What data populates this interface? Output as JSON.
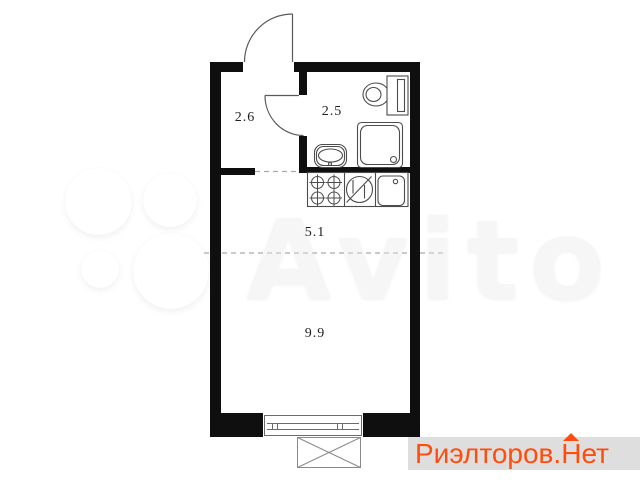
{
  "watermark": {
    "brand_text": "Avito",
    "text_color_hint": "#f3f3f3"
  },
  "floorplan": {
    "wall_color": "#0f0f0f",
    "rooms": [
      {
        "name": "hallway",
        "area_label": "2.6"
      },
      {
        "name": "bathroom",
        "area_label": "2.5"
      },
      {
        "name": "kitchen",
        "area_label": "5.1"
      },
      {
        "name": "living-room",
        "area_label": "9.9"
      }
    ],
    "fixture_icons": [
      "entrance-door-icon",
      "bathroom-door-icon",
      "toilet-icon",
      "shower-icon",
      "bathroom-sink-icon",
      "stove-burners-icon",
      "refrigerator-icon",
      "kitchen-sink-icon",
      "window-icon",
      "balcony-icon"
    ]
  },
  "badge": {
    "prefix": "Риэлторов.",
    "hat_letter": "Н",
    "suffix": "ет",
    "full_text": "Риэлторов.Нет",
    "text_color": "#ff4d0d",
    "background": "#dedede"
  }
}
